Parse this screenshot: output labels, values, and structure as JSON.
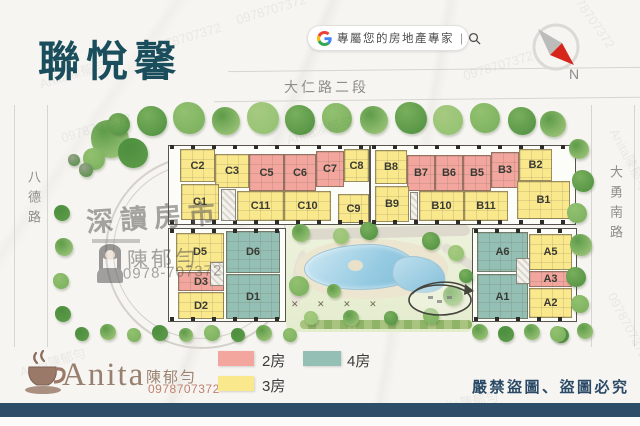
{
  "header": {
    "title": "聯悅馨",
    "search": {
      "icon": "google-g-icon",
      "text": "專屬您的房地產專家",
      "divider": "|",
      "search_icon": "magnifier-icon"
    },
    "compass_label": "N"
  },
  "roads": {
    "top": "大仁路二段",
    "left": "八德路",
    "right": "大勇南路"
  },
  "legend": {
    "items": [
      {
        "label": "2房",
        "color": "#f2a69e"
      },
      {
        "label": "3房",
        "color": "#fae98c"
      },
      {
        "label": "4房",
        "color": "#93bfb5"
      }
    ]
  },
  "map": {
    "blocks": [
      {
        "name": "C-building",
        "units": [
          {
            "id": "C2",
            "type": "3房",
            "x": 180,
            "y": 149,
            "w": 35,
            "h": 33
          },
          {
            "id": "C3",
            "type": "3房",
            "x": 215,
            "y": 154,
            "w": 34,
            "h": 34
          },
          {
            "id": "C5",
            "type": "2房",
            "x": 249,
            "y": 154,
            "w": 35,
            "h": 37
          },
          {
            "id": "C6",
            "type": "2房",
            "x": 284,
            "y": 154,
            "w": 32,
            "h": 37
          },
          {
            "id": "C7",
            "type": "2房",
            "x": 316,
            "y": 151,
            "w": 28,
            "h": 36
          },
          {
            "id": "C8",
            "type": "3房",
            "x": 344,
            "y": 149,
            "w": 25,
            "h": 33
          },
          {
            "id": "C1",
            "type": "3房",
            "x": 181,
            "y": 184,
            "w": 38,
            "h": 36
          },
          {
            "id": "C11",
            "type": "3房",
            "x": 237,
            "y": 191,
            "w": 47,
            "h": 30
          },
          {
            "id": "C10",
            "type": "3房",
            "x": 284,
            "y": 191,
            "w": 47,
            "h": 30
          },
          {
            "id": "C9",
            "type": "3房",
            "x": 338,
            "y": 194,
            "w": 31,
            "h": 29
          }
        ]
      },
      {
        "name": "B-building",
        "units": [
          {
            "id": "B8",
            "type": "3房",
            "x": 375,
            "y": 150,
            "w": 32,
            "h": 34
          },
          {
            "id": "B7",
            "type": "2房",
            "x": 407,
            "y": 155,
            "w": 28,
            "h": 36
          },
          {
            "id": "B6",
            "type": "2房",
            "x": 435,
            "y": 155,
            "w": 28,
            "h": 36
          },
          {
            "id": "B5",
            "type": "2房",
            "x": 463,
            "y": 155,
            "w": 28,
            "h": 36
          },
          {
            "id": "B3",
            "type": "2房",
            "x": 491,
            "y": 152,
            "w": 28,
            "h": 36
          },
          {
            "id": "B2",
            "type": "3房",
            "x": 519,
            "y": 149,
            "w": 33,
            "h": 32
          },
          {
            "id": "B1",
            "type": "3房",
            "x": 517,
            "y": 181,
            "w": 53,
            "h": 38
          },
          {
            "id": "B9",
            "type": "3房",
            "x": 375,
            "y": 186,
            "w": 34,
            "h": 36
          },
          {
            "id": "B10",
            "type": "3房",
            "x": 419,
            "y": 191,
            "w": 45,
            "h": 30
          },
          {
            "id": "B11",
            "type": "3房",
            "x": 464,
            "y": 191,
            "w": 44,
            "h": 30
          }
        ]
      },
      {
        "name": "D-building",
        "units": [
          {
            "id": "D5",
            "type": "3房",
            "x": 176,
            "y": 233,
            "w": 48,
            "h": 38
          },
          {
            "id": "D6",
            "type": "4房",
            "x": 226,
            "y": 231,
            "w": 54,
            "h": 42
          },
          {
            "id": "D3",
            "type": "2房",
            "x": 178,
            "y": 272,
            "w": 46,
            "h": 19
          },
          {
            "id": "D2",
            "type": "3房",
            "x": 178,
            "y": 292,
            "w": 46,
            "h": 27
          },
          {
            "id": "D1",
            "type": "4房",
            "x": 226,
            "y": 274,
            "w": 54,
            "h": 45
          }
        ]
      },
      {
        "name": "A-building",
        "units": [
          {
            "id": "A6",
            "type": "4房",
            "x": 477,
            "y": 232,
            "w": 51,
            "h": 40
          },
          {
            "id": "A5",
            "type": "3房",
            "x": 529,
            "y": 234,
            "w": 43,
            "h": 36
          },
          {
            "id": "A3",
            "type": "2房",
            "x": 529,
            "y": 271,
            "w": 43,
            "h": 16
          },
          {
            "id": "A2",
            "type": "3房",
            "x": 529,
            "y": 288,
            "w": 43,
            "h": 30
          },
          {
            "id": "A1",
            "type": "4房",
            "x": 477,
            "y": 274,
            "w": 51,
            "h": 45
          }
        ]
      }
    ]
  },
  "watermark": {
    "stamp": "深讀房市",
    "agent": "陳郁勻",
    "phone": "0978-707372",
    "diagonal_a": "Anita陳郁勻",
    "diagonal_b": "0978707372"
  },
  "footer": {
    "brand": "Anita",
    "agent": "陳郁勻",
    "phone": "0978707372",
    "warning": "嚴禁盜圖、盜圖必究"
  },
  "colors": {
    "accent_navy": "#2e4d68",
    "title": "#1a4e5c"
  }
}
